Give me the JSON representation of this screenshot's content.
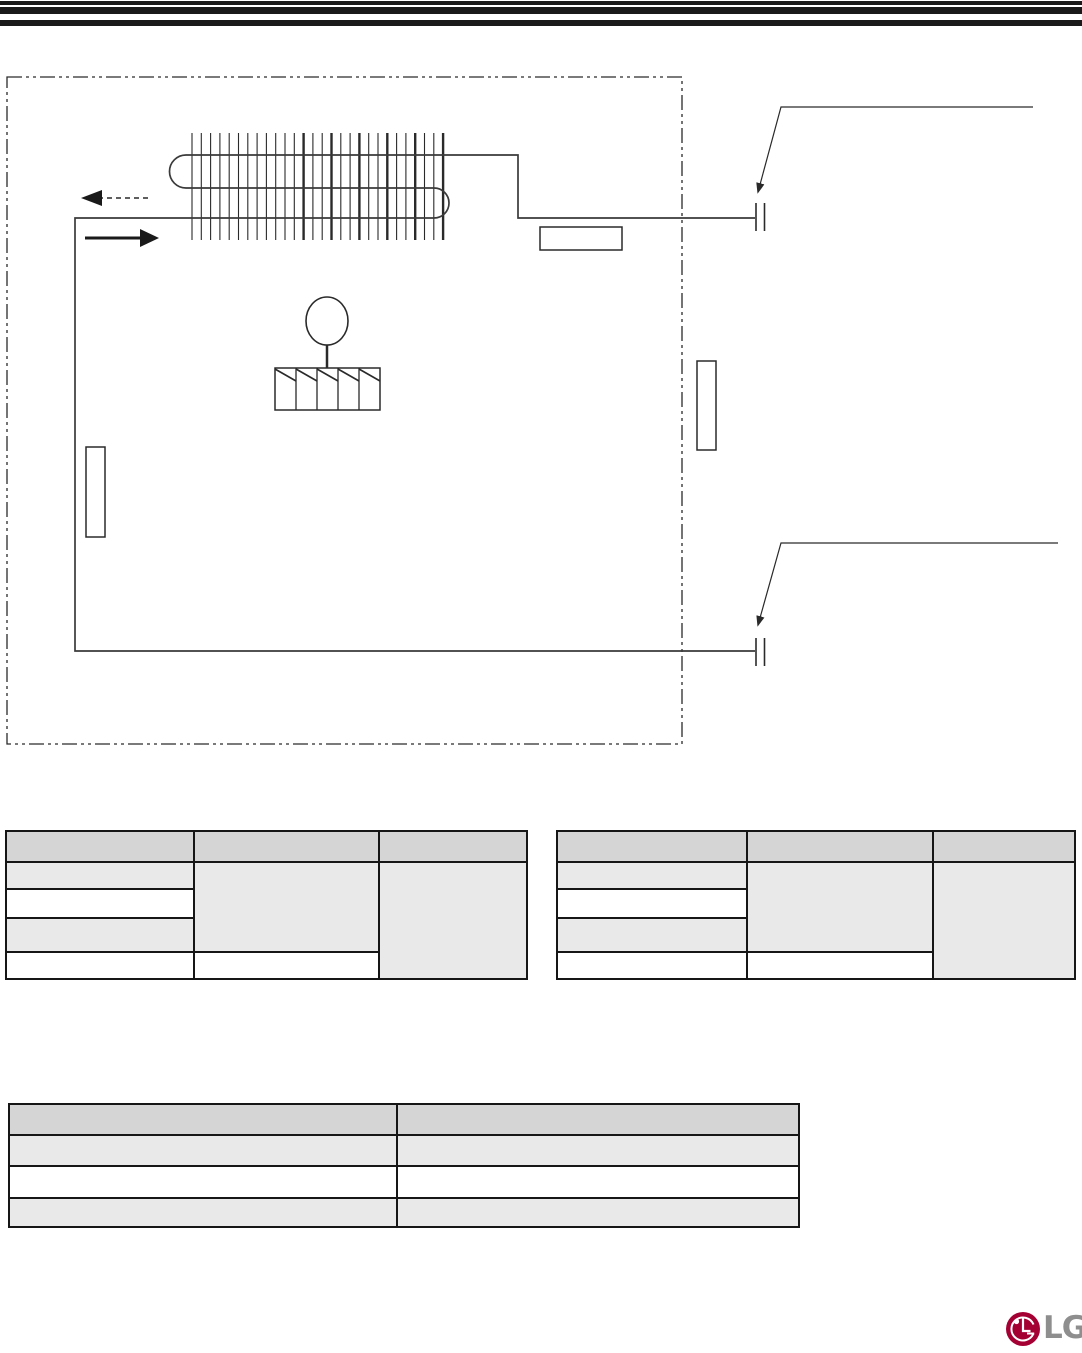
{
  "document": {
    "kind": "service-manual page",
    "content": "refrigeration cycle diagram with empty specification tables"
  },
  "diagram": {
    "type": "refrigerant-piping-schematic",
    "line_color": "#2a2a2a",
    "boundary_style": "dash-dot",
    "callout_box_labels": [
      "",
      "",
      ""
    ],
    "connection_points": 2
  },
  "tables": {
    "left": {
      "headers": [
        "",
        "",
        ""
      ],
      "body_rows": [
        [
          "",
          "",
          ""
        ],
        [
          "",
          ""
        ],
        [
          ""
        ],
        [
          "",
          ""
        ]
      ]
    },
    "right": {
      "headers": [
        "",
        "",
        ""
      ],
      "body_rows": [
        [
          "",
          "",
          ""
        ],
        [
          "",
          ""
        ],
        [
          ""
        ],
        [
          "",
          ""
        ]
      ]
    },
    "bottom": {
      "headers": [
        "",
        ""
      ],
      "body_rows": [
        [
          "",
          ""
        ],
        [
          "",
          ""
        ],
        [
          "",
          ""
        ]
      ]
    }
  },
  "logo": {
    "text": "LG",
    "symbol_color": "#a50034",
    "text_color": "#8e8e8e"
  }
}
